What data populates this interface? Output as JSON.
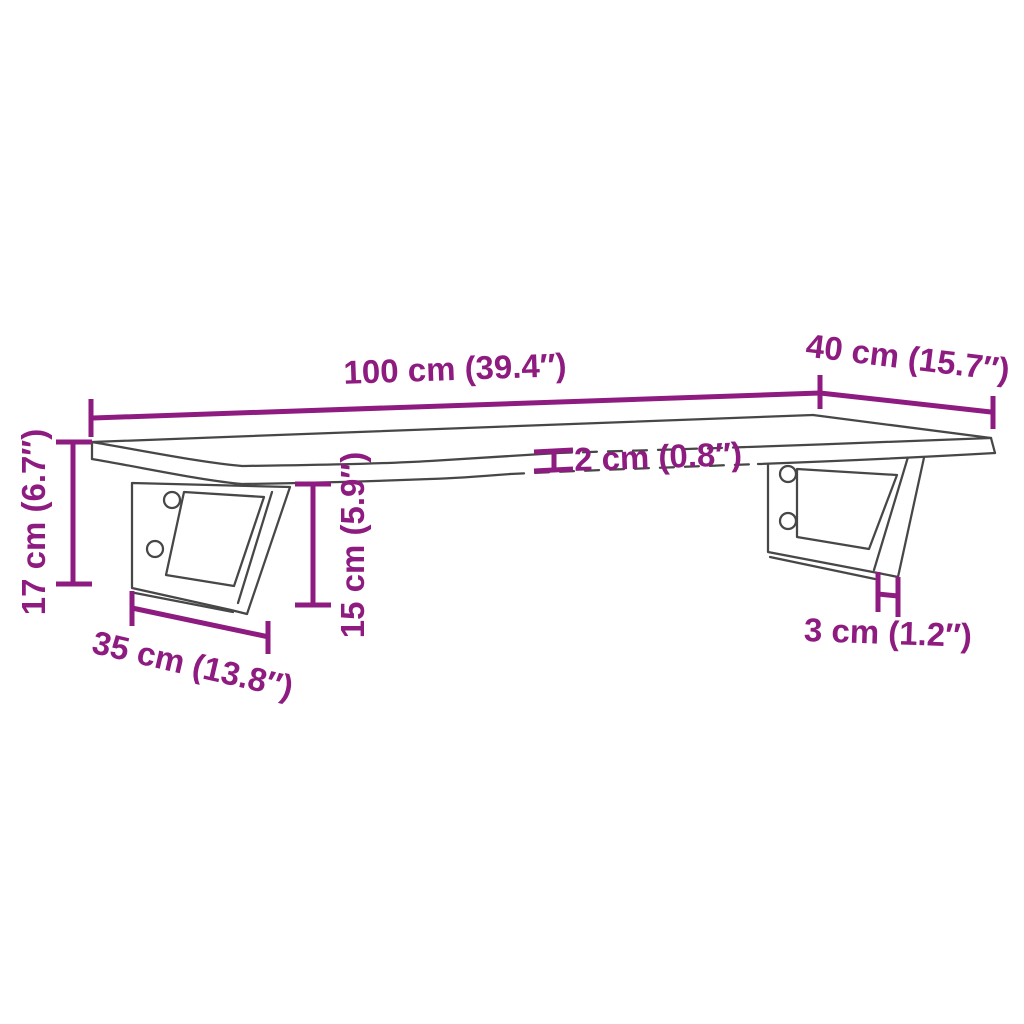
{
  "diagram": {
    "kind": "product dimension line drawing",
    "product": "wall-mounted shelf board on two brackets",
    "background_color": "#ffffff",
    "annotation_color": "#8e1b80",
    "drawing_line_color": "#474747",
    "dimensions": {
      "width": {
        "cm": "100",
        "in": "39.4",
        "label": "100 cm (39.4″)"
      },
      "depth": {
        "cm": "40",
        "in": "15.7",
        "label": "40 cm (15.7″)"
      },
      "height": {
        "cm": "17",
        "in": "6.7",
        "label": "17 cm (6.7″)"
      },
      "board_thickness": {
        "cm": "2",
        "in": "0.8",
        "label": "2 cm (0.8″)"
      },
      "bracket_height": {
        "cm": "15",
        "in": "5.9",
        "label": "15 cm (5.9″)"
      },
      "bracket_depth": {
        "cm": "35",
        "in": "13.8",
        "label": "35 cm (13.8″)"
      },
      "bracket_thickness": {
        "cm": "3",
        "in": "1.2",
        "label": "3 cm (1.2″)"
      }
    }
  }
}
